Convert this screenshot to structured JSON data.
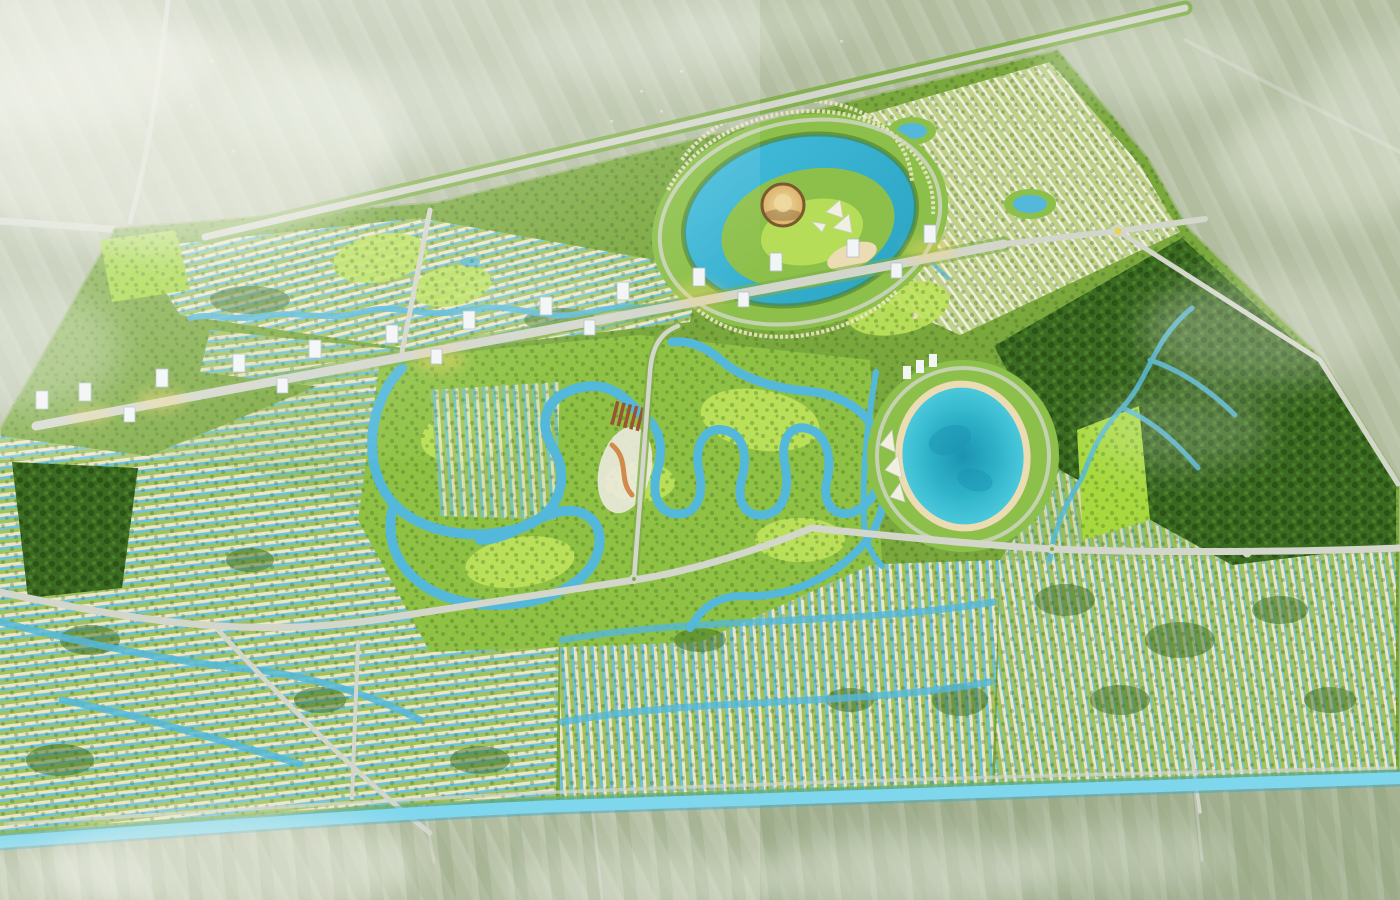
{
  "scene": {
    "type": "aerial-masterplan-rendering",
    "description": "Bird's-eye 3D rendering of a vast eco-township master plan: thousands of villa rows laced with blue canals, a central golf course, a landmark lake with a golden dome arena and white sail pavilions, an oval turquoise lagoon, dark forest parkland, a tower-lined central boulevard, all bounded by a highway to the north and a cyan river to the south, surrounded by hazy farmland and clouds",
    "time_of_day": "daytime with soft sunlight and golden glow on the towers"
  },
  "landmarks": {
    "dome_arena": "golden dome arena on lake island",
    "sail_pavilions": "white sail-shaped pavilions beside the dome",
    "landmark_lake": "free-form turquoise lake with central island",
    "crystal_lagoon": "large oval turquoise lagoon with sand rim",
    "event_lawn": "bright lime rectangular lawn east of the lagoon",
    "golf_course": "fairways wrapped by winding looping canals",
    "central_boulevard": "diagonal axis flanked by white high-rise slabs",
    "forest_park": "dense dark woodland with creeks on the east side",
    "boundary_river": "cyan river along the southern edge",
    "highway": "regional highway along the north-west boundary",
    "villa_districts": "low-rise villa rows separated by blue canals"
  },
  "counts": {
    "highrise_towers": 19,
    "roundabouts": 4,
    "lakes": 2,
    "lagoons": 1,
    "sail_pavilions": 3
  },
  "colors": {
    "farmland_base": "#b9c3a8",
    "farmland_stripe": "#9cab87",
    "farmland_light": "#cdd5bd",
    "farmland_dark": "#879c74",
    "cloud_white": "#f3f6ee",
    "site_base": "#7aa83d",
    "park_green": "#8cc04a",
    "golf_base": "#8fc244",
    "fairway_lime": "#bce25a",
    "event_lawn": "#a7d93f",
    "forest_green": "#3b6b21",
    "forest_dark": "#2b5317",
    "tree_speckle": "#2f5c1a",
    "canal_blue": "#54b8da",
    "canal_bright": "#8fdef2",
    "river_blue": "#7fd7ee",
    "river_deep": "#3fa8cc",
    "lake_blue": "#45bedd",
    "lake_deep": "#2aa3c2",
    "lagoon_deep": "#1b93b2",
    "lagoon_mid": "#2fb3c9",
    "lagoon_edge": "#4ecbde",
    "sand": "#ecdcb4",
    "house_cream": "#ece6c8",
    "row_green": "#a2c25e",
    "row_white": "#f0efe0",
    "row_blue": "#6cc3de",
    "ne_gap": "#bed187",
    "road_gray": "#d3d6cb",
    "road_verge": "#7fae46",
    "tower_white": "#f2f5f6",
    "tower_shade": "#aebec6",
    "dome_gold": "#dcb26a",
    "dome_gold_light": "#eed9a0",
    "dome_rim": "#7b5a2f",
    "glow_gold": "#ffd96e",
    "roundabout_yellow": "#e8d44a",
    "club_roof": "#9c5233",
    "plaza_white": "#eceade",
    "path_orange": "#d08a4a",
    "village_speck": "#e8e6da"
  }
}
